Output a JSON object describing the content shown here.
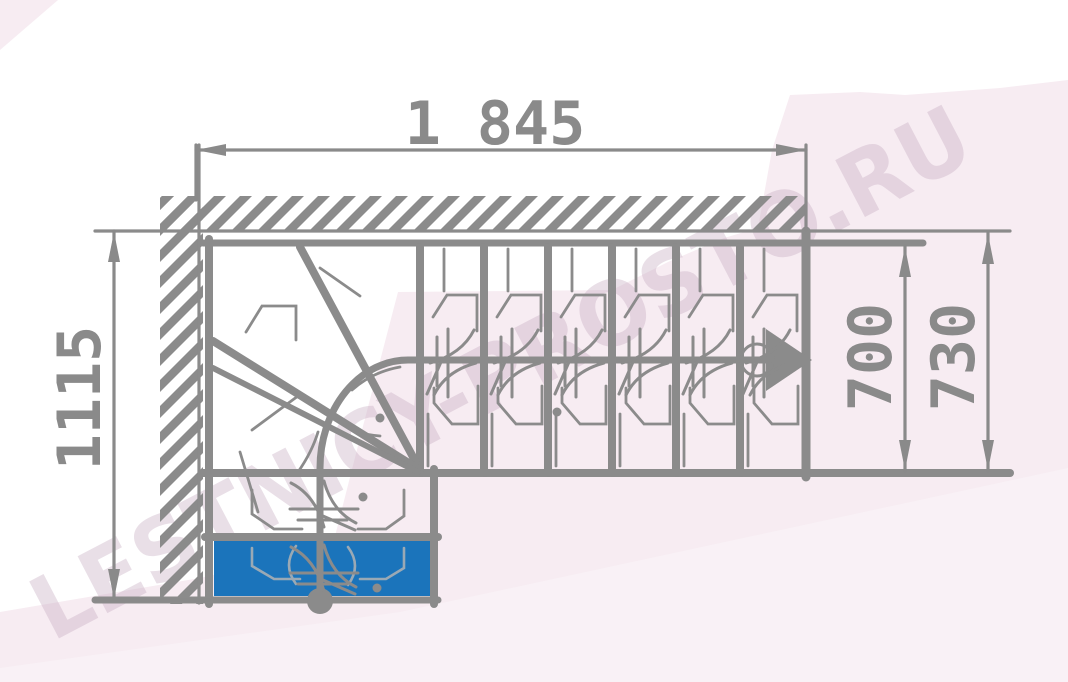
{
  "page": {
    "description": "Technical floor-plan drawing of a quarter-turn (L-shaped) staircase with winder steps, dimension lines and a walk-line arrow",
    "type": "staircase-floor-plan"
  },
  "watermark": {
    "text": "LESTNICY-PROSTO.RU"
  },
  "dimensions": {
    "top_width": "1 845",
    "left_depth": "1115",
    "flight_width_inner": "700",
    "flight_width_outer": "730"
  },
  "stair": {
    "straight_flight_treads": 6,
    "lower_flight_treads": 2,
    "winder_corner": true,
    "highlighted_step": "bottom entry step highlighted in blue",
    "walk_line_direction": "up from bottom step, turning right toward arrow"
  },
  "colors": {
    "line": "#8b8b8b",
    "highlight_blue": "#1b74bb",
    "watermark_band": "#f7ecf2",
    "watermark_band_light": "#f9f3f6",
    "watermark_text": "#c9b0c2"
  }
}
